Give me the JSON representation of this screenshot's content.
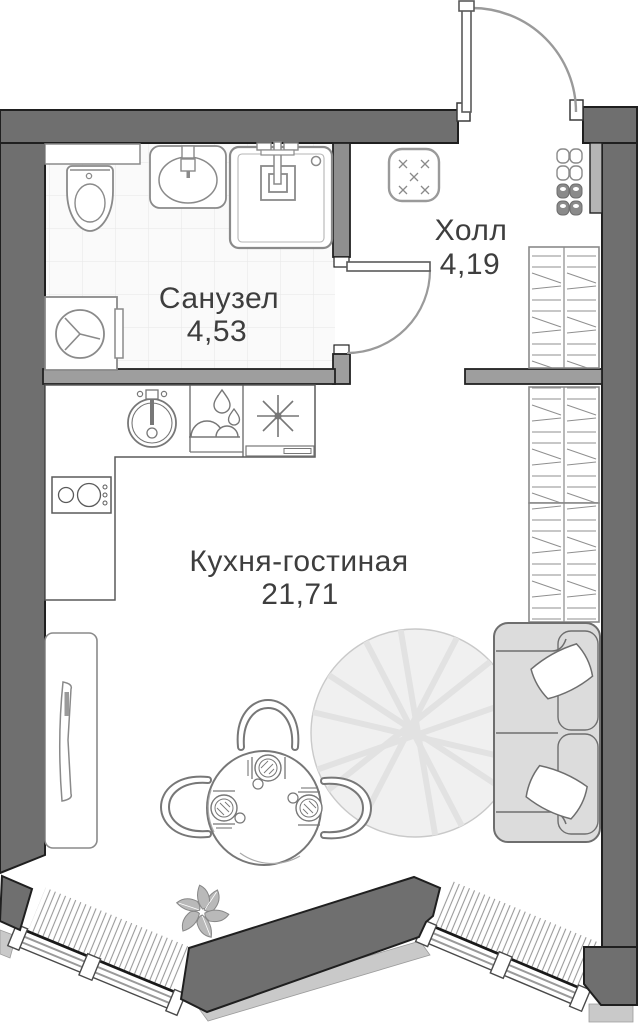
{
  "plan": {
    "type": "apartment-floor-plan",
    "rooms": [
      {
        "id": "bathroom",
        "name": "Санузел",
        "area": "4,53"
      },
      {
        "id": "hall",
        "name": "Холл",
        "area": "4,19"
      },
      {
        "id": "kitchen_living",
        "name": "Кухня-гостиная",
        "area": "21,71"
      }
    ],
    "colors": {
      "outer_wall": "#6f6f6f",
      "partition_wall": "#9e9e9e",
      "wall_outline": "#1f1f1f",
      "furniture_stroke": "#8a8a8a",
      "label_text": "#3e3e3e",
      "exterior_ledge": "#c9c9c9",
      "sofa_fill": "#dcdcdc",
      "rug_fill": "#f0f0f0",
      "tile_line": "#e9e9e9"
    },
    "symbols": [
      "entry-door",
      "bathroom-door",
      "toilet",
      "bathroom-sink",
      "shower",
      "washing-machine",
      "pouf",
      "shoes",
      "closet",
      "kitchen-sink",
      "dishwasher",
      "stove",
      "cooktop",
      "tv-stand",
      "tv",
      "dining-table",
      "dining-chairs",
      "place-settings",
      "rug",
      "sofa",
      "pillows",
      "plant",
      "window",
      "radiator"
    ]
  }
}
